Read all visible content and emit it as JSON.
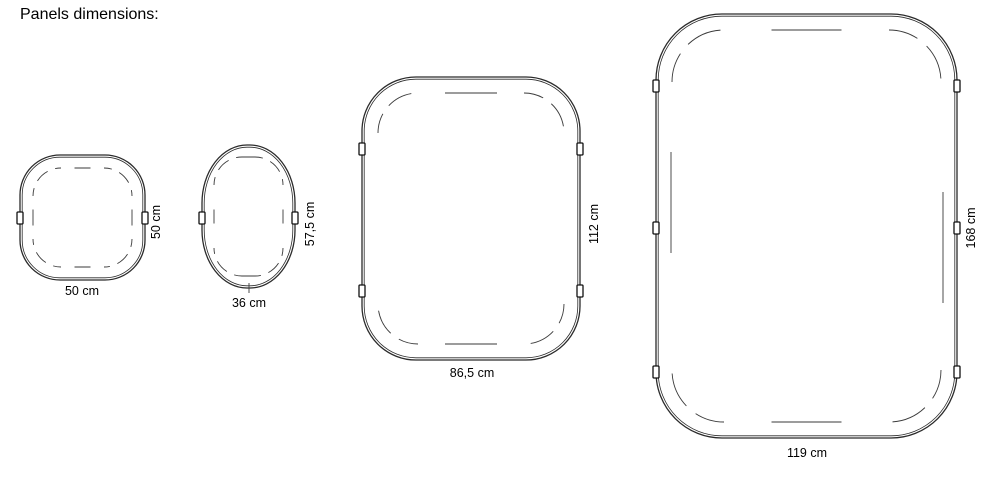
{
  "title": "Panels dimensions:",
  "colors": {
    "line": "#2b2b2b",
    "dash": "#3a3a3a",
    "tab_stroke": "#111111",
    "background": "#ffffff",
    "text": "#000000"
  },
  "panels": [
    {
      "name": "small-square",
      "width_label": "50 cm",
      "height_label": "50 cm",
      "geometry": {
        "box": [
          20,
          155,
          125,
          125
        ],
        "rx": 40,
        "ry": 40,
        "outline_gap": 2.2,
        "dash_inset": 13,
        "dash_r": 28,
        "arc_dash": "14 8",
        "edge_dash_half": 8,
        "side_dashes": true,
        "tabs": [
          [
            "left",
            218
          ],
          [
            "right",
            218
          ]
        ],
        "extra_lines": []
      }
    },
    {
      "name": "oval",
      "width_label": "36 cm",
      "height_label": "57,5 cm",
      "geometry": {
        "box": [
          202,
          145,
          93,
          143
        ],
        "rx": 45,
        "ry": 58,
        "outline_gap": 2.2,
        "dash_inset": 12,
        "dash_r": 28,
        "arc_dash": "14 8",
        "edge_dash_half": 7,
        "side_dashes": true,
        "tabs": [
          [
            "left",
            218
          ],
          [
            "right",
            218
          ]
        ],
        "extra_lines": [
          [
            249,
            283,
            249,
            293
          ]
        ]
      }
    },
    {
      "name": "medium",
      "width_label": "86,5 cm",
      "height_label": "112 cm",
      "geometry": {
        "box": [
          362,
          77,
          218,
          283
        ],
        "rx": 54,
        "ry": 54,
        "outline_gap": 2.2,
        "dash_inset": 16,
        "dash_r": 40,
        "arc_dash": "26 10",
        "edge_dash_half": 26,
        "side_dashes": false,
        "tabs": [
          [
            "left",
            149
          ],
          [
            "left",
            291
          ],
          [
            "right",
            149
          ],
          [
            "right",
            291
          ]
        ],
        "extra_lines": []
      }
    },
    {
      "name": "large",
      "width_label": "119 cm",
      "height_label": "168 cm",
      "geometry": {
        "box": [
          656,
          14,
          301,
          424
        ],
        "rx": 66,
        "ry": 66,
        "outline_gap": 2.2,
        "dash_inset": 16,
        "dash_r": 52,
        "arc_dash": "36 12",
        "edge_dash_half": 35,
        "side_dashes": false,
        "tabs": [
          [
            "left",
            86
          ],
          [
            "left",
            228
          ],
          [
            "left",
            372
          ],
          [
            "right",
            86
          ],
          [
            "right",
            228
          ],
          [
            "right",
            372
          ]
        ],
        "extra_lines": [
          [
            671,
            152,
            671,
            253
          ],
          [
            943,
            192,
            943,
            303
          ]
        ]
      }
    }
  ]
}
